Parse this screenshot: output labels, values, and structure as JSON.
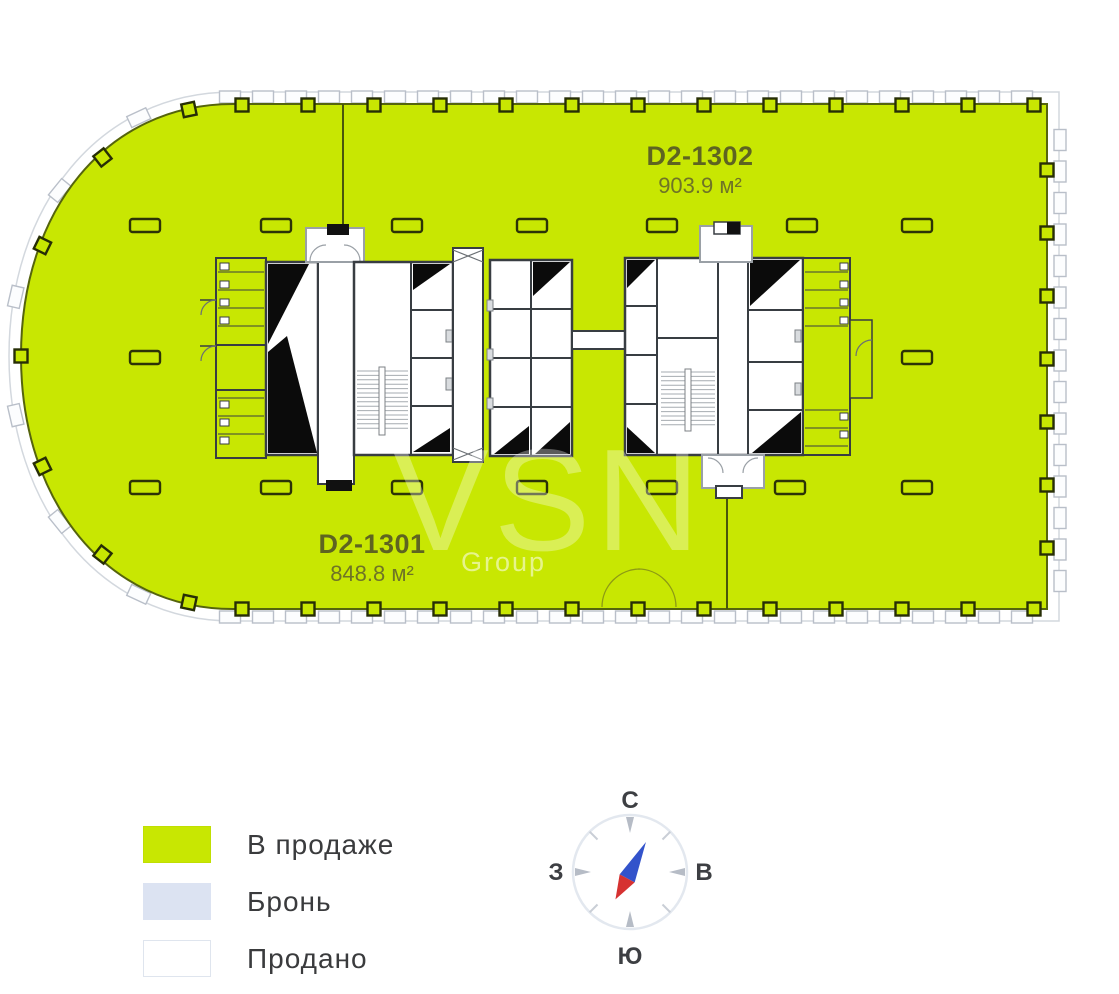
{
  "plan": {
    "units": [
      {
        "id": "D2-1302",
        "area": "903.9 м²"
      },
      {
        "id": "D2-1301",
        "area": "848.8 м²"
      }
    ],
    "watermark": {
      "brand": "VSN",
      "suffix": "Group"
    }
  },
  "legend": {
    "items": [
      {
        "label": "В продаже",
        "swatch": "#c8e702",
        "border": "#c0df02"
      },
      {
        "label": "Бронь",
        "swatch": "#dce3f2",
        "border": "#dce3f2"
      },
      {
        "label": "Продано",
        "swatch": "#ffffff",
        "border": "#dfe5ee"
      }
    ]
  },
  "compass": {
    "north": "С",
    "south": "Ю",
    "west": "З",
    "east": "В"
  },
  "colors": {
    "available_fill": "#c8e702",
    "plan_outline": "#55640d",
    "core_wall": "#383d42",
    "needle_north": "#3353cb",
    "needle_south": "#d63231"
  }
}
